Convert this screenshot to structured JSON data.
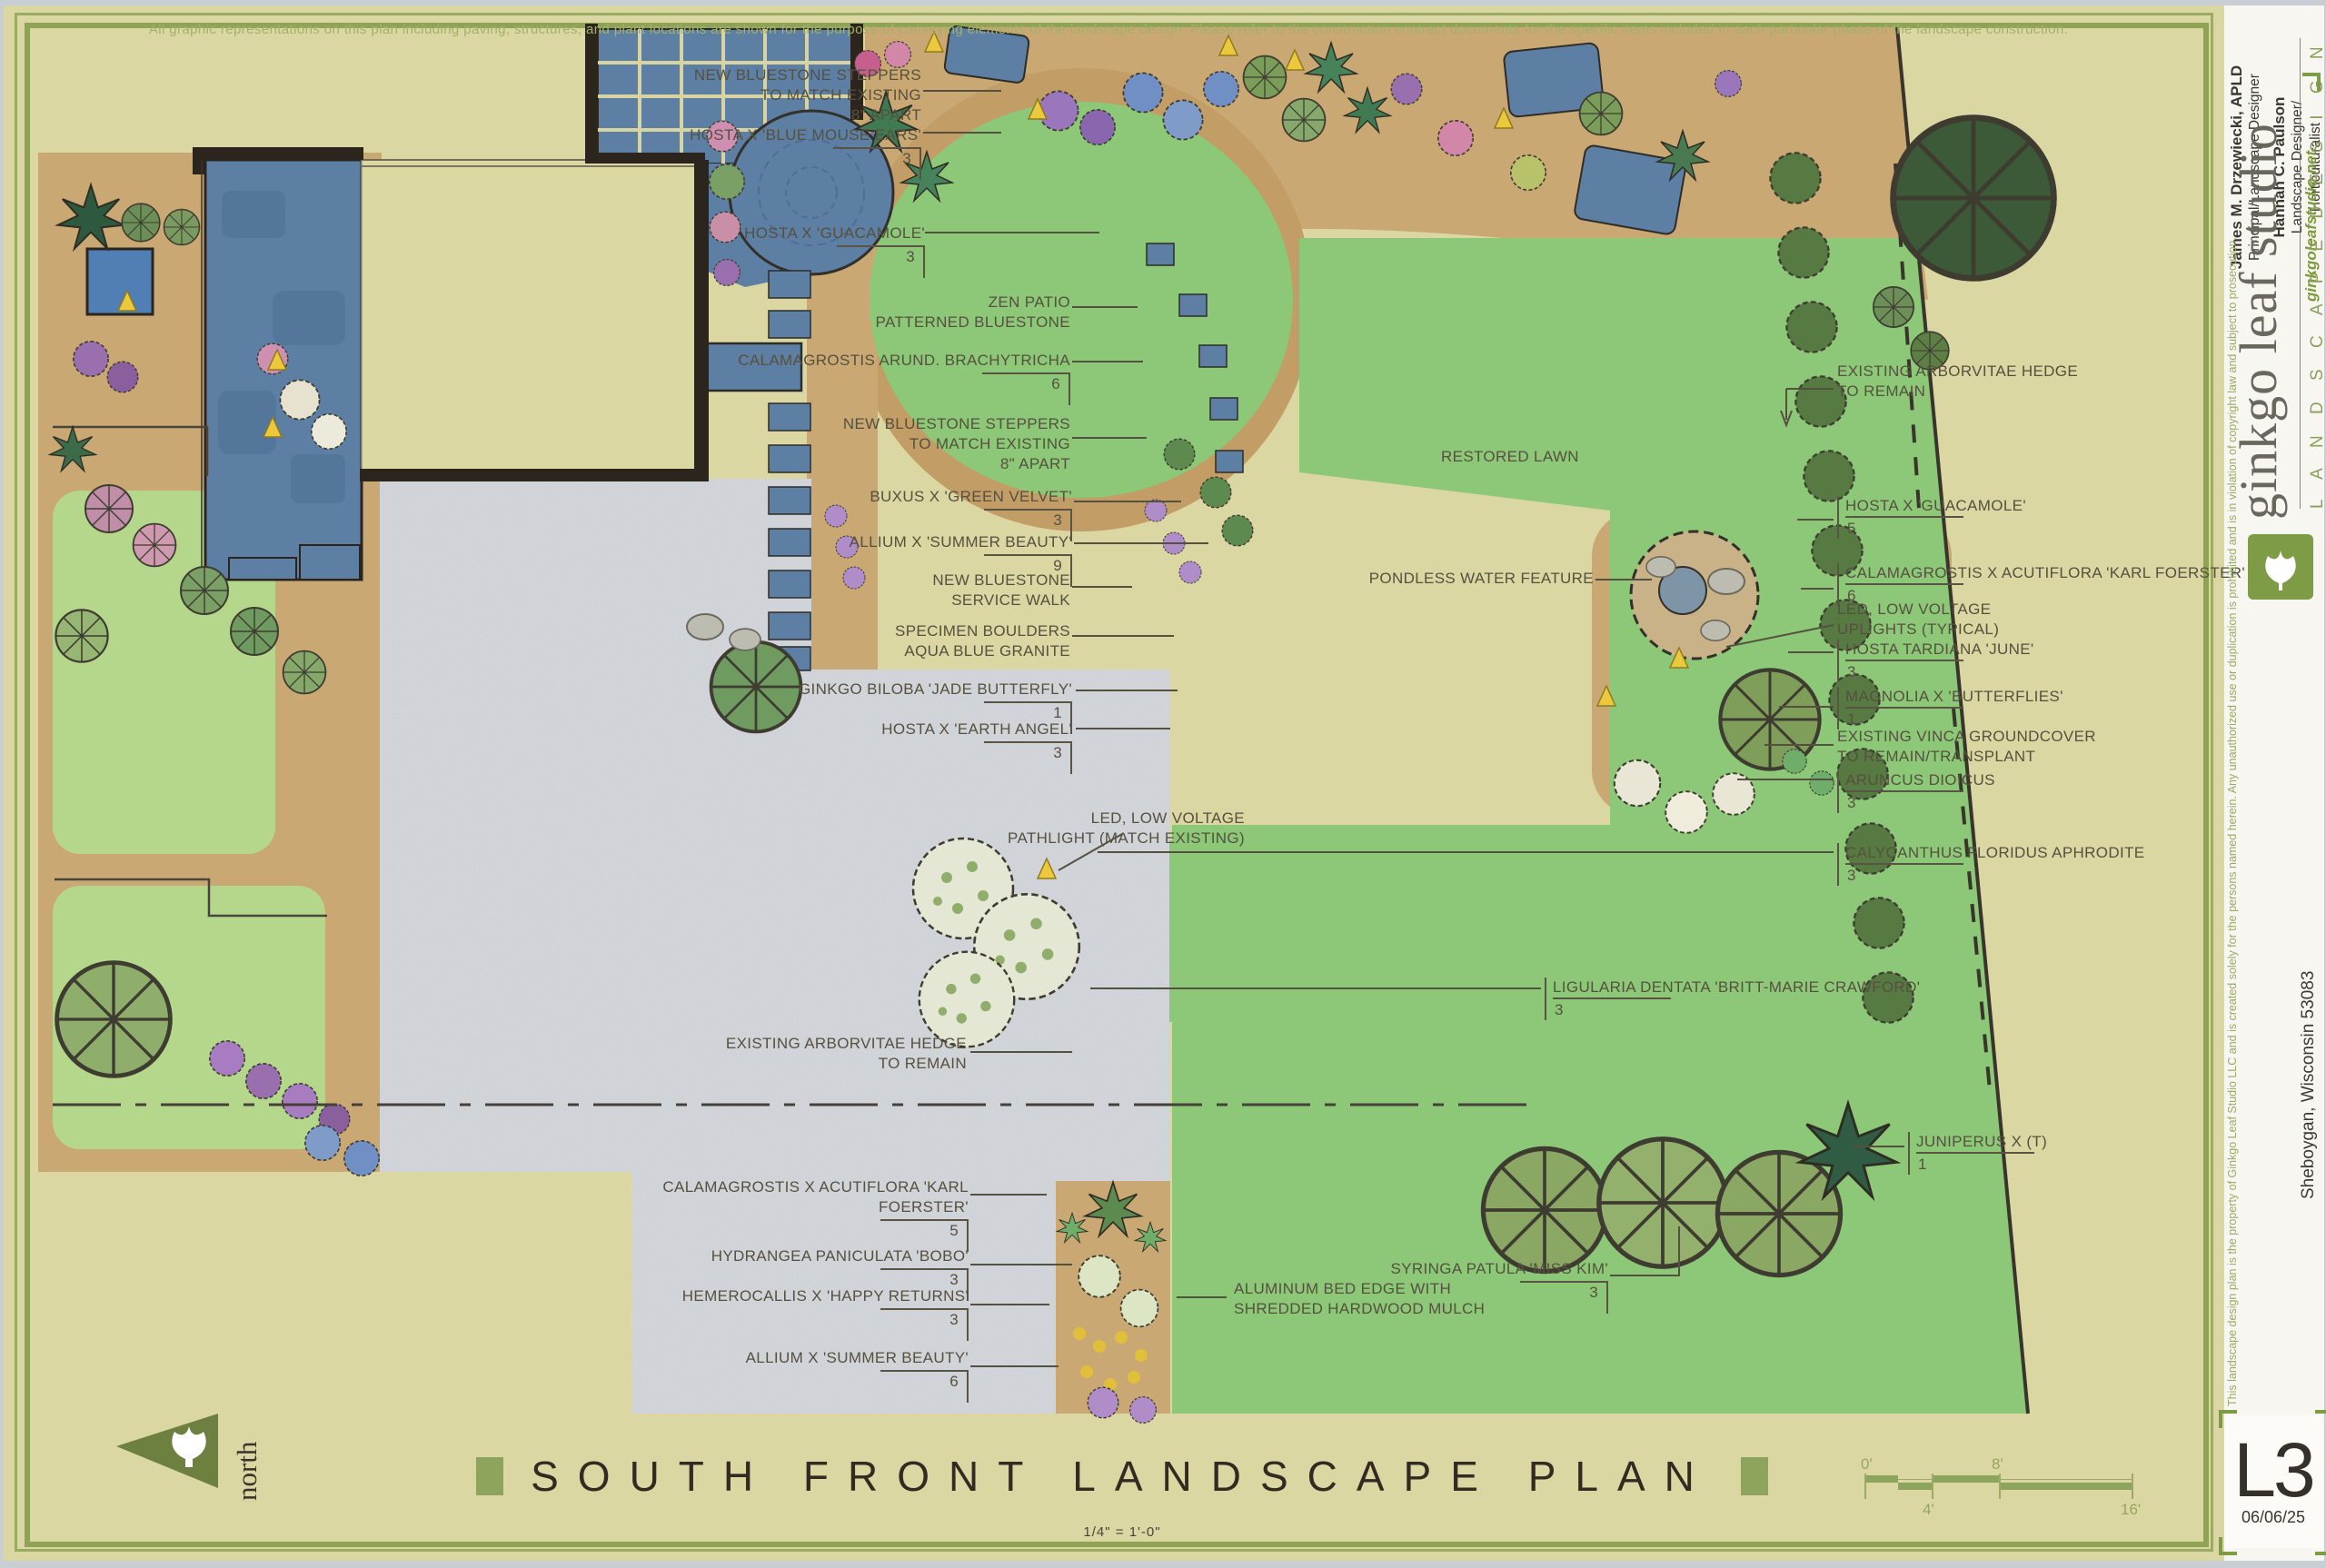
{
  "disclaimer": "All graphic representations on this plan including paving, structures, and plant locations are shown for the purpose of conveying elements of the landscape design.  Please refer to the construction contract documents for the specific items included in each particular phase of the landscape construction.",
  "title_block": {
    "staff": [
      {
        "name": "James M. Drzewiecki, APLD",
        "role": "Principal/Landscape Designer"
      },
      {
        "name": "Hannah C. Paulson",
        "role": "Landscape Designer/\nHorticulturalist"
      }
    ],
    "website": "ginkgoleafstudio.net",
    "studio_name": "ginkgo leaf studio",
    "tagline": "L A N D S C A P E   D E S I G N",
    "address": "Sheboygan, Wisconsin 53083",
    "copyright": "This landscape design plan is the property of Ginkgo Leaf Studio LLC and is created solely for the persons named herein.  Any unauthorized use or duplication is prohibited and is in violation of copyright law and subject to prosecution.",
    "sheet_number": "L3",
    "date": "06/06/25"
  },
  "footer": {
    "title": "SOUTH FRONT LANDSCAPE PLAN",
    "scale_note": "1/4\" = 1'-0\"",
    "north_label": "north",
    "scale_bar": {
      "d0": "0'",
      "d8": "8'",
      "d4": "4'",
      "d16": "16'"
    }
  },
  "plan_labels": [
    {
      "text": "NEW BLUESTONE STEPPERS\nTO MATCH EXISTING\n8\" APART"
    },
    {
      "text": "HOSTA X 'BLUE MOUSE EARS'",
      "qty": "3"
    },
    {
      "text": "HOSTA X 'GUACAMOLE'",
      "qty": "3"
    },
    {
      "text": "ZEN PATIO\nPATTERNED BLUESTONE"
    },
    {
      "text": "CALAMAGROSTIS ARUND. BRACHYTRICHA",
      "qty": "6"
    },
    {
      "text": "NEW BLUESTONE STEPPERS\nTO MATCH EXISTING\n8\" APART"
    },
    {
      "text": "BUXUS X 'GREEN VELVET'",
      "qty": "3"
    },
    {
      "text": "ALLIUM X 'SUMMER BEAUTY'",
      "qty": "9"
    },
    {
      "text": "NEW BLUESTONE\nSERVICE WALK"
    },
    {
      "text": "SPECIMEN BOULDERS\nAQUA BLUE GRANITE"
    },
    {
      "text": "GINKGO BILOBA 'JADE BUTTERFLY'",
      "qty": "1"
    },
    {
      "text": "HOSTA X 'EARTH ANGEL'",
      "qty": "3"
    },
    {
      "text": "LED, LOW VOLTAGE\nPATHLIGHT (MATCH EXISTING)"
    },
    {
      "text": "RESTORED LAWN"
    },
    {
      "text": "PONDLESS WATER FEATURE"
    },
    {
      "text": "EXISTING ARBORVITAE HEDGE\nTO REMAIN"
    },
    {
      "text": "HOSTA X 'GUACAMOLE'",
      "qty": "5"
    },
    {
      "text": "CALAMAGROSTIS X ACUTIFLORA 'KARL FOERSTER'",
      "qty": "6"
    },
    {
      "text": "LED, LOW VOLTAGE\nUPLIGHTS (TYPICAL)"
    },
    {
      "text": "HOSTA TARDIANA 'JUNE'",
      "qty": "3"
    },
    {
      "text": "MAGNOLIA X 'BUTTERFLIES'",
      "qty": "1"
    },
    {
      "text": "EXISTING VINCA GROUNDCOVER\nTO REMAIN/TRANSPLANT"
    },
    {
      "text": "ARUNCUS DIOICUS",
      "qty": "3"
    },
    {
      "text": "CALYCANTHUS FLORIDUS APHRODITE",
      "qty": "3"
    },
    {
      "text": "LIGULARIA DENTATA 'BRITT-MARIE CRAWFORD'",
      "qty": "3"
    },
    {
      "text": "JUNIPERUS X (T)",
      "qty": "1"
    },
    {
      "text": "EXISTING ARBORVITAE HEDGE\nTO REMAIN"
    },
    {
      "text": "CALAMAGROSTIS X ACUTIFLORA 'KARL FOERSTER'",
      "qty": "5"
    },
    {
      "text": "HYDRANGEA PANICULATA 'BOBO'",
      "qty": "3"
    },
    {
      "text": "HEMEROCALLIS X 'HAPPY RETURNS'",
      "qty": "3"
    },
    {
      "text": "ALLIUM X 'SUMMER BEAUTY'",
      "qty": "6"
    },
    {
      "text": "ALUMINUM BED EDGE WITH\nSHREDDED HARDWOOD MULCH"
    },
    {
      "text": "SYRINGA PATULA 'MISS KIM'",
      "qty": "3"
    }
  ]
}
